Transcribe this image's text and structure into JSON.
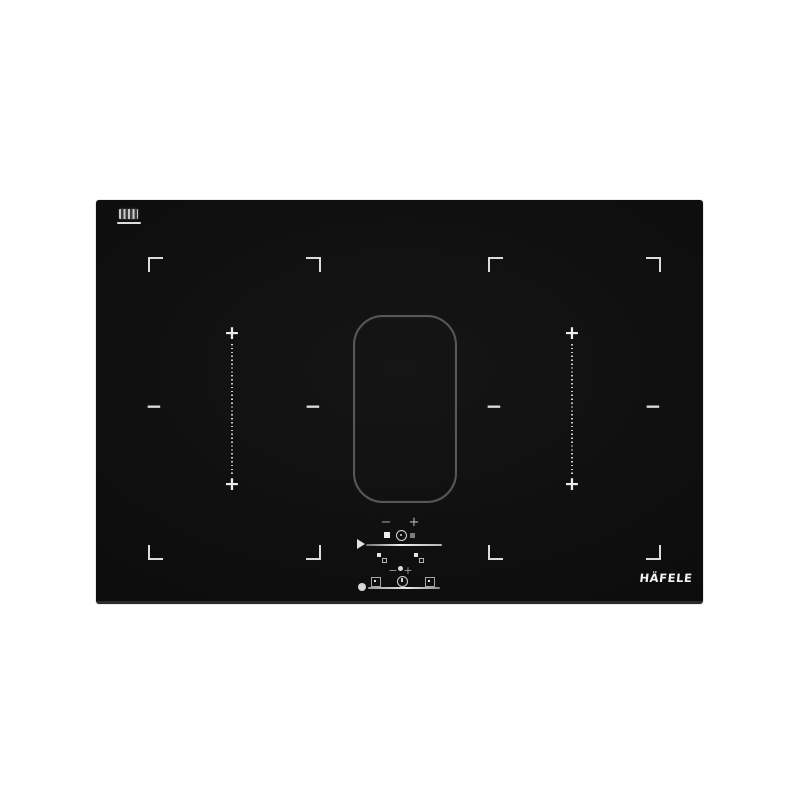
{
  "brand": {
    "logo_text": "HÄFELE"
  },
  "glyphs": {
    "plus": "+",
    "minus": "−"
  },
  "colors": {
    "background": "#ffffff",
    "glass": "#0d0d0d",
    "marking_bright": "#e8e8e8",
    "marking_dim": "#9a9a9a",
    "flex_ring_outline": "#585858",
    "bottom_edge": "#2c2c2c"
  },
  "icons": {
    "badge": "induction-coil-badge",
    "corner_brackets": "cooking-zone-corner-bracket",
    "bridge_marks": "bridge-zone-plus-minus-marks",
    "flex_ring": "central-flex-zone-outline",
    "slider_pointer": "play-triangle",
    "stop": "stop-square",
    "timer": "timer-dial",
    "pause": "dim-square",
    "bridge_left": "flex-bridge-key",
    "bridge_right": "flex-bridge-key",
    "vent_left": "vent-mode-key",
    "clock": "clock-key",
    "vent_right": "vent-mode-key",
    "power": "power-dot"
  },
  "controls": {
    "hob": {
      "minus": "−",
      "plus": "+"
    },
    "vent": {
      "minus": "−",
      "plus": "+"
    }
  }
}
